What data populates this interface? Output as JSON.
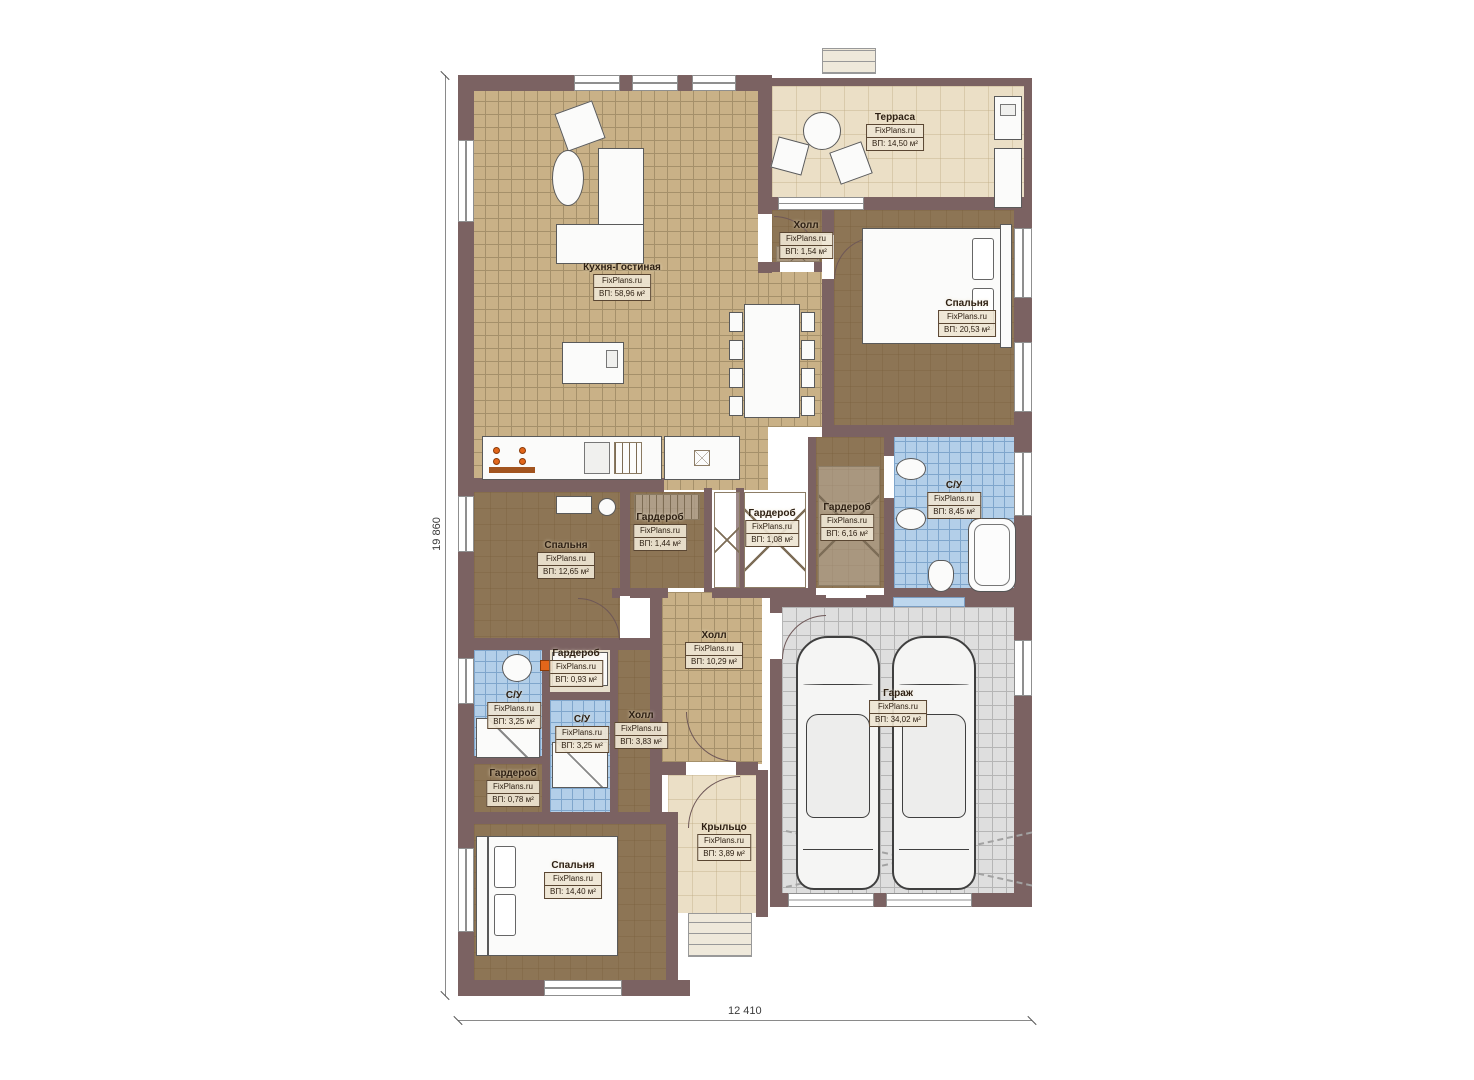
{
  "plan": {
    "brand_watermark": "FixPlans.ru",
    "dimensions": {
      "left": "19 860",
      "bottom": "12 410"
    },
    "colors": {
      "wall": "#7b6262",
      "tile_tan": "#c9b187",
      "tile_blue": "#b3cfe9",
      "tile_gray": "#dedede",
      "floor_brown": "#8d7555",
      "floor_beige": "#ebdfc6",
      "accent_orange": "#e2661a"
    }
  },
  "rooms": [
    {
      "id": "terrace",
      "name": "Терраса",
      "brand": "FixPlans.ru",
      "area": "ВП: 14,50 м²"
    },
    {
      "id": "hall-top",
      "name": "Холл",
      "brand": "FixPlans.ru",
      "area": "ВП: 1,54 м²"
    },
    {
      "id": "bedroom-right",
      "name": "Спальня",
      "brand": "FixPlans.ru",
      "area": "ВП: 20,53 м²"
    },
    {
      "id": "kitchen-living",
      "name": "Кухня-Гостиная",
      "brand": "FixPlans.ru",
      "area": "ВП: 58,96 м²"
    },
    {
      "id": "bathroom-right",
      "name": "С/У",
      "brand": "FixPlans.ru",
      "area": "ВП: 8,45 м²"
    },
    {
      "id": "wardrobe-1",
      "name": "Гардероб",
      "brand": "FixPlans.ru",
      "area": "ВП: 1,44 м²"
    },
    {
      "id": "wardrobe-2",
      "name": "Гардероб",
      "brand": "FixPlans.ru",
      "area": "ВП: 1,08 м²"
    },
    {
      "id": "wardrobe-3",
      "name": "Гардероб",
      "brand": "FixPlans.ru",
      "area": "ВП: 6,16 м²"
    },
    {
      "id": "bedroom-left",
      "name": "Спальня",
      "brand": "FixPlans.ru",
      "area": "ВП: 12,65 м²"
    },
    {
      "id": "hall-center",
      "name": "Холл",
      "brand": "FixPlans.ru",
      "area": "ВП: 10,29 м²"
    },
    {
      "id": "garage",
      "name": "Гараж",
      "brand": "FixPlans.ru",
      "area": "ВП: 34,02 м²"
    },
    {
      "id": "bathroom-left",
      "name": "С/У",
      "brand": "FixPlans.ru",
      "area": "ВП: 3,25 м²"
    },
    {
      "id": "wardrobe-4",
      "name": "Гардероб",
      "brand": "FixPlans.ru",
      "area": "ВП: 0,93 м²"
    },
    {
      "id": "bathroom-mid",
      "name": "С/У",
      "brand": "FixPlans.ru",
      "area": "ВП: 3,25 м²"
    },
    {
      "id": "hall-lower",
      "name": "Холл",
      "brand": "FixPlans.ru",
      "area": "ВП: 3,83 м²"
    },
    {
      "id": "wardrobe-5",
      "name": "Гардероб",
      "brand": "FixPlans.ru",
      "area": "ВП: 0,78 м²"
    },
    {
      "id": "bedroom-bottom",
      "name": "Спальня",
      "brand": "FixPlans.ru",
      "area": "ВП: 14,40 м²"
    },
    {
      "id": "porch",
      "name": "Крыльцо",
      "brand": "FixPlans.ru",
      "area": "ВП: 3,89 м²"
    }
  ]
}
